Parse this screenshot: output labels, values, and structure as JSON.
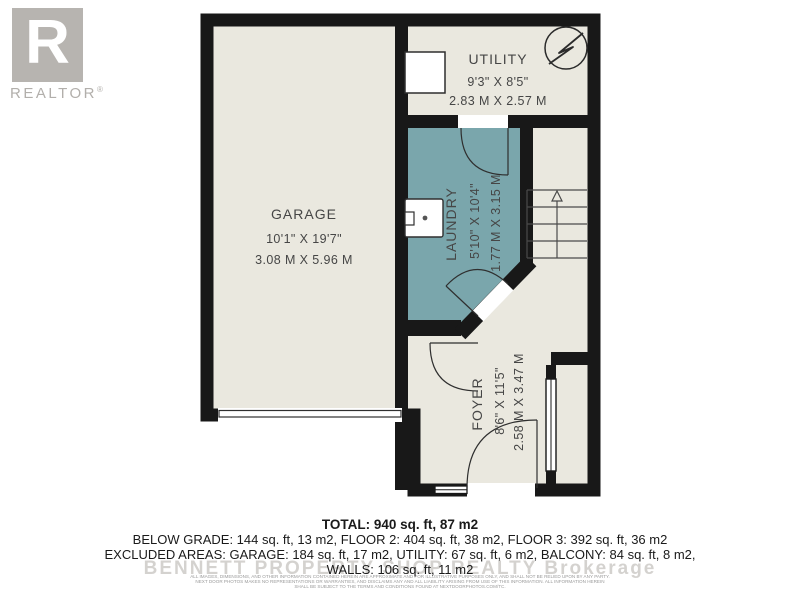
{
  "branding": {
    "logo_letter": "R",
    "logo_text": "REALTOR",
    "registered_mark": "®"
  },
  "floorplan": {
    "rooms": {
      "garage": {
        "name": "GARAGE",
        "imperial": "10'1\" X 19'7\"",
        "metric": "3.08 M X 5.96 M"
      },
      "utility": {
        "name": "UTILITY",
        "imperial": "9'3\" X 8'5\"",
        "metric": "2.83 M X 2.57 M"
      },
      "laundry": {
        "name": "LAUNDRY",
        "imperial": "5'10\" X 10'4\"",
        "metric": "1.77 M X 3.15 M"
      },
      "foyer": {
        "name": "FOYER",
        "imperial": "8'6\" X 11'5\"",
        "metric": "2.58 M X 3.47 M"
      }
    },
    "icons": {
      "electrical_panel": "lightning-bolt-in-circle",
      "stairs_direction": "up-arrow",
      "sink": "laundry-sink",
      "appliance": "utility-appliance-box"
    }
  },
  "summary": {
    "total": "TOTAL: 940 sq. ft, 87 m2",
    "floors_line": "BELOW GRADE: 144 sq. ft, 13 m2, FLOOR 2: 404 sq. ft, 38 m2, FLOOR 3: 392 sq. ft, 36 m2",
    "excluded_line": "EXCLUDED AREAS: GARAGE: 184 sq. ft, 17 m2, UTILITY: 67 sq. ft, 6 m2, BALCONY: 84 sq. ft, 8 m2,",
    "walls_line": "WALLS: 106 sq. ft, 11 m2"
  },
  "watermark": "BENNETT PROPERTY SHOP REALTY Brokerage",
  "disclaimer": {
    "line1": "ALL IMAGES, DIMENSIONS, AND OTHER INFORMATION CONTAINED HEREIN ARE APPROXIMATE AND FOR ILLUSTRATIVE PURPOSES ONLY, AND SHALL NOT BE RELIED UPON BY ANY PARTY.",
    "line2": "NEXT DOOR PHOTOS MAKES NO REPRESENTATIONS OR WARRANTIES, AND DISCLAIMS ANY AND ALL LIABILITY ARISING FROM USE OF THIS INFORMATION. ALL INFORMATION HEREIN",
    "line3": "SHALL BE SUBJECT TO THE TERMS AND CONDITIONS FOUND AT NEXTDOORPHOTOS.COM/TC."
  },
  "colors": {
    "wall": "#181818",
    "floor": "#eae8df",
    "laundry_floor": "#7aa6ac",
    "label": "#464646",
    "logo_gray": "#b7b4b0"
  }
}
